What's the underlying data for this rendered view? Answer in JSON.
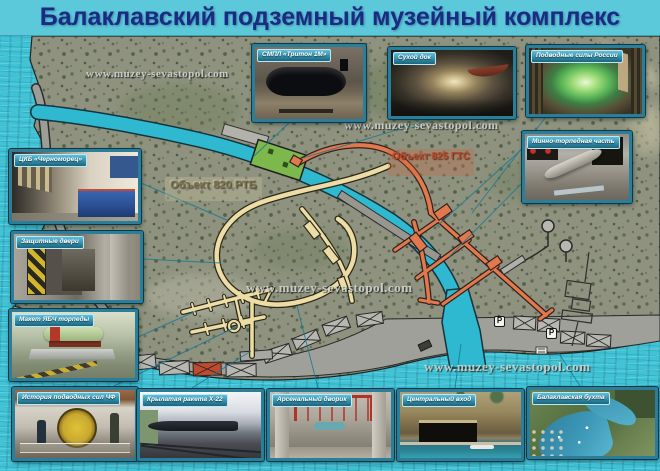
{
  "title": "Балаклавский подземный музейный комплекс",
  "watermark": "www.muzey-sevastopol.com",
  "map": {
    "object820_label": "Объект 820 РТБ",
    "object825_label": "Объект 825 ГТС",
    "parking_label": "P",
    "colors": {
      "water": "#41c3d6",
      "canal": "#2fb9d0",
      "object820": "#ecdca6",
      "object825": "#e2794e",
      "dry_dock_green": "#7cb84c",
      "road": "#a0a09a"
    }
  },
  "photos": [
    {
      "id": "triton",
      "caption": "СМПЛ «Тритон 1М»"
    },
    {
      "id": "drydock",
      "caption": "Сухой док"
    },
    {
      "id": "subforces",
      "caption": "Подводные силы России"
    },
    {
      "id": "torpedo-section",
      "caption": "Минно-торпедная часть"
    },
    {
      "id": "ckb",
      "caption": "ЦКБ «Черноморец»"
    },
    {
      "id": "doors",
      "caption": "Защитные двери"
    },
    {
      "id": "warhead",
      "caption": "Макет ЯБЧ торпеды"
    },
    {
      "id": "history",
      "caption": "История подводных сил ЧФ"
    },
    {
      "id": "missile",
      "caption": "Крылатая ракета Х-22"
    },
    {
      "id": "arsenal",
      "caption": "Арсенальный дворик"
    },
    {
      "id": "entrance",
      "caption": "Центральный вход"
    },
    {
      "id": "bay",
      "caption": "Балаклавская бухта"
    }
  ]
}
